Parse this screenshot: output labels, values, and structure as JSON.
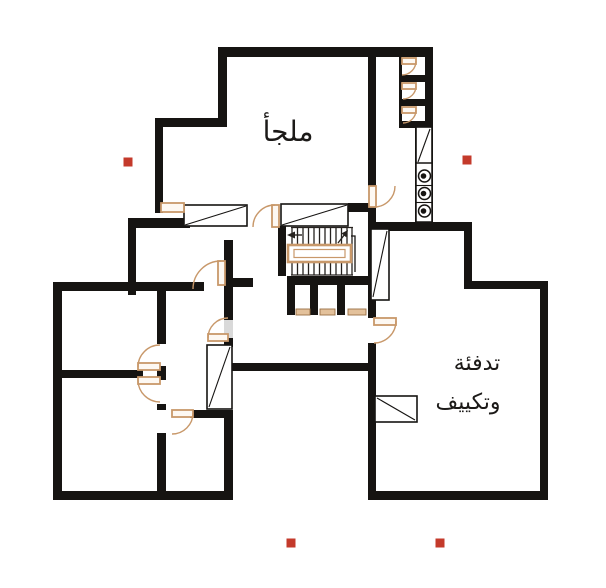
{
  "labels": {
    "shelter": "ملجأ",
    "hvac_line1": "تدفئة",
    "hvac_line2": "وتكييف"
  },
  "colors": {
    "background": "#ffffff",
    "wall": "#161412",
    "door": "#c8986a",
    "doorFill": "#fdf8f2",
    "sillFill": "#e3c19b",
    "sillBorder": "#9a7144",
    "glass": "#d9d9d9",
    "marker": "#c43a2b",
    "ink": "#1c1a18"
  },
  "markers": {
    "size": 9,
    "items": [
      {
        "x": 128,
        "y": 162
      },
      {
        "x": 467,
        "y": 160
      },
      {
        "x": 291,
        "y": 543
      },
      {
        "x": 440,
        "y": 543
      }
    ]
  }
}
